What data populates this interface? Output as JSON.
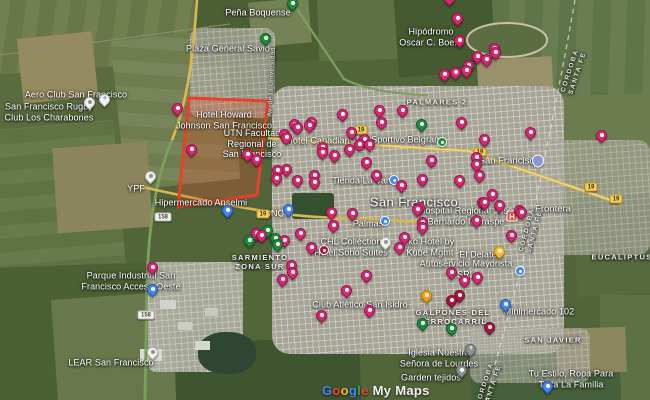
{
  "watermark": {
    "brand_letters": [
      [
        "G",
        "#4285F4"
      ],
      [
        "o",
        "#EA4335"
      ],
      [
        "o",
        "#FBBC04"
      ],
      [
        "g",
        "#4285F4"
      ],
      [
        "l",
        "#34A853"
      ],
      [
        "e",
        "#EA4335"
      ]
    ],
    "suffix": "My Maps"
  },
  "region_highlight": {
    "points": "189,98 268,101 257,195 178,207",
    "stroke": "#e8402a",
    "fill": "rgba(232,78,48,0.28)"
  },
  "route_shields": [
    {
      "label": "19",
      "style": "yellow",
      "x": 361,
      "y": 130
    },
    {
      "label": "19",
      "style": "yellow",
      "x": 480,
      "y": 152
    },
    {
      "label": "19",
      "style": "yellow",
      "x": 591,
      "y": 187
    },
    {
      "label": "19",
      "style": "yellow",
      "x": 616,
      "y": 199
    },
    {
      "label": "19",
      "style": "yellow",
      "x": 263,
      "y": 214
    },
    {
      "label": "158",
      "style": "white",
      "x": 163,
      "y": 217
    },
    {
      "label": "158",
      "style": "white",
      "x": 146,
      "y": 315
    }
  ],
  "place_labels": [
    {
      "lines": [
        "Peña Boquense"
      ],
      "kind": "poi",
      "x": 258,
      "y": 13
    },
    {
      "lines": [
        "Plaza General Savio"
      ],
      "kind": "poi",
      "x": 228,
      "y": 49
    },
    {
      "lines": [
        "Hipódromo",
        "Oscar C. Boero"
      ],
      "kind": "poi",
      "x": 431,
      "y": 37
    },
    {
      "lines": [
        "Aero Club San Francisco"
      ],
      "kind": "poi",
      "x": 76,
      "y": 95
    },
    {
      "lines": [
        "San Francisco Rugby",
        "Club Los Charabones"
      ],
      "kind": "poi",
      "x": 49,
      "y": 112
    },
    {
      "lines": [
        "Hotel Howard",
        "Johnson San Francisco"
      ],
      "kind": "poi",
      "x": 224,
      "y": 120
    },
    {
      "lines": [
        "UTN Facultad",
        "Regional de",
        "San Francisco"
      ],
      "kind": "poi",
      "x": 252,
      "y": 144
    },
    {
      "lines": [
        "Hotel Canadian"
      ],
      "kind": "poi",
      "x": 318,
      "y": 141
    },
    {
      "lines": [
        "Club Sportivo Belgrano"
      ],
      "kind": "poi",
      "x": 397,
      "y": 140
    },
    {
      "lines": [
        "Hospital Regional José",
        "Bernardo Iturraspe"
      ],
      "kind": "poi",
      "x": 466,
      "y": 216
    },
    {
      "lines": [
        "Tienda La Vans"
      ],
      "kind": "poi",
      "x": 364,
      "y": 181
    },
    {
      "lines": [
        "Palmas"
      ],
      "kind": "poi",
      "x": 368,
      "y": 224
    },
    {
      "lines": [
        "Hipermercado Anselmi"
      ],
      "kind": "poi",
      "x": 201,
      "y": 203
    },
    {
      "lines": [
        "YPF"
      ],
      "kind": "poi",
      "x": 136,
      "y": 189
    },
    {
      "lines": [
        "GNC"
      ],
      "kind": "poi",
      "x": 274,
      "y": 214
    },
    {
      "lines": [
        "CHL Collection",
        "Hotel Soho Suites"
      ],
      "kind": "poi",
      "x": 351,
      "y": 247
    },
    {
      "lines": [
        "Iko Hotel by",
        "Kube Mgmt"
      ],
      "kind": "poi",
      "x": 430,
      "y": 247
    },
    {
      "lines": [
        "El Delate"
      ],
      "kind": "poi",
      "x": 478,
      "y": 255
    },
    {
      "lines": [
        "Autoservicio Mayorista",
        "SRL"
      ],
      "kind": "poi",
      "x": 466,
      "y": 269
    },
    {
      "lines": [
        "Club Atlético San Isidro"
      ],
      "kind": "poi",
      "x": 360,
      "y": 305
    },
    {
      "lines": [
        "Minimercado 102"
      ],
      "kind": "poi",
      "x": 539,
      "y": 312
    },
    {
      "lines": [
        "Iglesia Nuestra",
        "Señora de Lourdes"
      ],
      "kind": "poi",
      "x": 439,
      "y": 358
    },
    {
      "lines": [
        "Garden tejidos"
      ],
      "kind": "poi",
      "x": 431,
      "y": 378
    },
    {
      "lines": [
        "Tu Estilo, Ropa Para",
        "Toda La Familia"
      ],
      "kind": "poi",
      "x": 571,
      "y": 379
    },
    {
      "lines": [
        "Parque Industrial San",
        "Francisco Acceso Oeste"
      ],
      "kind": "poi",
      "x": 131,
      "y": 281
    },
    {
      "lines": [
        "LEAR San Francisco"
      ],
      "kind": "poi",
      "x": 111,
      "y": 363
    },
    {
      "lines": [
        "PALMARES 2"
      ],
      "kind": "area",
      "x": 437,
      "y": 103
    },
    {
      "lines": [
        "SARMIENTO",
        "ZONA SUR"
      ],
      "kind": "area",
      "x": 260,
      "y": 263
    },
    {
      "lines": [
        "GALPONES DEL",
        "FERROCARRIL"
      ],
      "kind": "area",
      "x": 453,
      "y": 318
    },
    {
      "lines": [
        "SAN JAVIER"
      ],
      "kind": "area",
      "x": 553,
      "y": 341
    },
    {
      "lines": [
        "EUCALIPTUS"
      ],
      "kind": "area",
      "x": 622,
      "y": 258
    },
    {
      "lines": [
        "CORDOBA",
        "SANTA FE"
      ],
      "kind": "border-lbl",
      "x": 574,
      "y": 72,
      "rotate": -72
    },
    {
      "lines": [
        "CORDOBA",
        "SANTA FE"
      ],
      "kind": "border-lbl",
      "x": 531,
      "y": 231,
      "rotate": -75
    },
    {
      "lines": [
        "CORDOBA",
        "SANTA FE"
      ],
      "kind": "border-lbl",
      "x": 489,
      "y": 385,
      "rotate": -72
    },
    {
      "lines": [
        "San Francisco"
      ],
      "kind": "citybig",
      "x": 414,
      "y": 202
    },
    {
      "lines": [
        "San Francisco"
      ],
      "kind": "city",
      "x": 509,
      "y": 161
    },
    {
      "lines": [
        "Frontera"
      ],
      "kind": "city",
      "x": 553,
      "y": 209
    },
    {
      "lines": [
        "Av. de la Universidad"
      ],
      "kind": "road-lbl",
      "x": 272,
      "y": 82,
      "rotate": -87
    }
  ],
  "markers": [
    [
      450,
      6,
      "pink"
    ],
    [
      458,
      26,
      "pink"
    ],
    [
      460,
      48,
      "pink"
    ],
    [
      495,
      56,
      "pink"
    ],
    [
      478,
      64,
      "pink"
    ],
    [
      487,
      67,
      "pink"
    ],
    [
      496,
      60,
      "pink"
    ],
    [
      469,
      73,
      "pink"
    ],
    [
      445,
      82,
      "pink"
    ],
    [
      456,
      80,
      "pink"
    ],
    [
      467,
      78,
      "pink"
    ],
    [
      343,
      122,
      "pink"
    ],
    [
      380,
      118,
      "pink"
    ],
    [
      403,
      118,
      "pink"
    ],
    [
      462,
      130,
      "pink"
    ],
    [
      287,
      145,
      "pink"
    ],
    [
      298,
      135,
      "pink"
    ],
    [
      312,
      130,
      "pink"
    ],
    [
      323,
      155,
      "pink"
    ],
    [
      335,
      163,
      "pink"
    ],
    [
      350,
      157,
      "pink"
    ],
    [
      360,
      152,
      "pink"
    ],
    [
      365,
      147,
      "pink"
    ],
    [
      370,
      152,
      "pink"
    ],
    [
      382,
      130,
      "pink"
    ],
    [
      352,
      140,
      "pink"
    ],
    [
      192,
      157,
      "pink"
    ],
    [
      248,
      162,
      "pink"
    ],
    [
      257,
      167,
      "pink"
    ],
    [
      278,
      178,
      "pink"
    ],
    [
      287,
      177,
      "pink"
    ],
    [
      285,
      142,
      "pink"
    ],
    [
      295,
      132,
      "pink"
    ],
    [
      310,
      133,
      "pink"
    ],
    [
      315,
      183,
      "pink"
    ],
    [
      323,
      160,
      "pink"
    ],
    [
      367,
      170,
      "pink"
    ],
    [
      377,
      183,
      "pink"
    ],
    [
      402,
      193,
      "pink"
    ],
    [
      423,
      187,
      "pink"
    ],
    [
      432,
      168,
      "pink"
    ],
    [
      477,
      165,
      "pink"
    ],
    [
      460,
      188,
      "pink"
    ],
    [
      418,
      217,
      "pink"
    ],
    [
      332,
      220,
      "pink"
    ],
    [
      353,
      221,
      "pink"
    ],
    [
      485,
      147,
      "pink"
    ],
    [
      531,
      140,
      "pink"
    ],
    [
      480,
      183,
      "pink"
    ],
    [
      477,
      172,
      "pink"
    ],
    [
      493,
      202,
      "pink"
    ],
    [
      483,
      210,
      "pink"
    ],
    [
      500,
      213,
      "pink"
    ],
    [
      520,
      218,
      "pink"
    ],
    [
      602,
      143,
      "pink"
    ],
    [
      420,
      215,
      "pink"
    ],
    [
      423,
      230,
      "pink"
    ],
    [
      477,
      228,
      "pink"
    ],
    [
      522,
      220,
      "pink"
    ],
    [
      512,
      243,
      "pink"
    ],
    [
      485,
      210,
      "pink"
    ],
    [
      277,
      186,
      "pink"
    ],
    [
      298,
      188,
      "pink"
    ],
    [
      315,
      190,
      "pink"
    ],
    [
      257,
      241,
      "pink"
    ],
    [
      262,
      243,
      "pink"
    ],
    [
      301,
      241,
      "pink"
    ],
    [
      334,
      233,
      "pink"
    ],
    [
      285,
      248,
      "pink"
    ],
    [
      312,
      255,
      "pink"
    ],
    [
      292,
      273,
      "pink"
    ],
    [
      283,
      287,
      "pink"
    ],
    [
      293,
      280,
      "pink"
    ],
    [
      347,
      298,
      "pink"
    ],
    [
      367,
      283,
      "pink"
    ],
    [
      322,
      323,
      "pink"
    ],
    [
      370,
      318,
      "pink"
    ],
    [
      405,
      245,
      "pink"
    ],
    [
      400,
      255,
      "pink"
    ],
    [
      423,
      235,
      "pink"
    ],
    [
      452,
      280,
      "pink"
    ],
    [
      465,
      288,
      "pink"
    ],
    [
      478,
      285,
      "pink"
    ],
    [
      178,
      116,
      "pink"
    ],
    [
      153,
      275,
      "pink"
    ],
    [
      452,
      308,
      "darkred"
    ],
    [
      460,
      303,
      "darkred"
    ],
    [
      490,
      335,
      "darkred"
    ],
    [
      324,
      250,
      "darkred",
      "dot"
    ],
    [
      293,
      11,
      "green"
    ],
    [
      266,
      46,
      "green"
    ],
    [
      250,
      248,
      "green"
    ],
    [
      268,
      238,
      "green"
    ],
    [
      276,
      246,
      "green"
    ],
    [
      278,
      252,
      "green"
    ],
    [
      423,
      331,
      "green"
    ],
    [
      452,
      336,
      "green"
    ],
    [
      422,
      132,
      "green"
    ],
    [
      442,
      142,
      "green",
      "dot"
    ],
    [
      427,
      303,
      "orange"
    ],
    [
      500,
      259,
      "yellow"
    ],
    [
      289,
      217,
      "blue"
    ],
    [
      228,
      218,
      "blue"
    ],
    [
      153,
      297,
      "blue"
    ],
    [
      506,
      312,
      "blue"
    ],
    [
      548,
      394,
      "blue"
    ],
    [
      394,
      180,
      "blue",
      "dot"
    ],
    [
      385,
      221,
      "blue",
      "dot"
    ],
    [
      520,
      271,
      "blue",
      "dot"
    ],
    [
      287,
      211,
      "blue",
      "dot"
    ],
    [
      90,
      110,
      "white"
    ],
    [
      105,
      107,
      "white",
      "plane"
    ],
    [
      151,
      184,
      "white"
    ],
    [
      153,
      360,
      "white"
    ],
    [
      386,
      250,
      "white"
    ],
    [
      471,
      357,
      "gray",
      "church"
    ],
    [
      462,
      378,
      "gray"
    ],
    [
      538,
      161,
      "blue",
      "cityshield"
    ],
    [
      512,
      216,
      "red",
      "hospital"
    ]
  ],
  "palette": {
    "pink": [
      "#d62a6f",
      "#9c1550"
    ],
    "darkred": [
      "#ad1444",
      "#751032"
    ],
    "green": [
      "#1e8e3e",
      "#0f6327"
    ],
    "orange": [
      "#f4a10c",
      "#c27b06"
    ],
    "yellow": [
      "#f9bb2d",
      "#c98f12"
    ],
    "blue": [
      "#4285f4",
      "#2a5db0"
    ],
    "white": [
      "#f2f3ee",
      "#b9bcb4"
    ],
    "gray": [
      "#8d9297",
      "#5f6368"
    ],
    "red": [
      "#e8453c",
      "#b3271e"
    ]
  }
}
